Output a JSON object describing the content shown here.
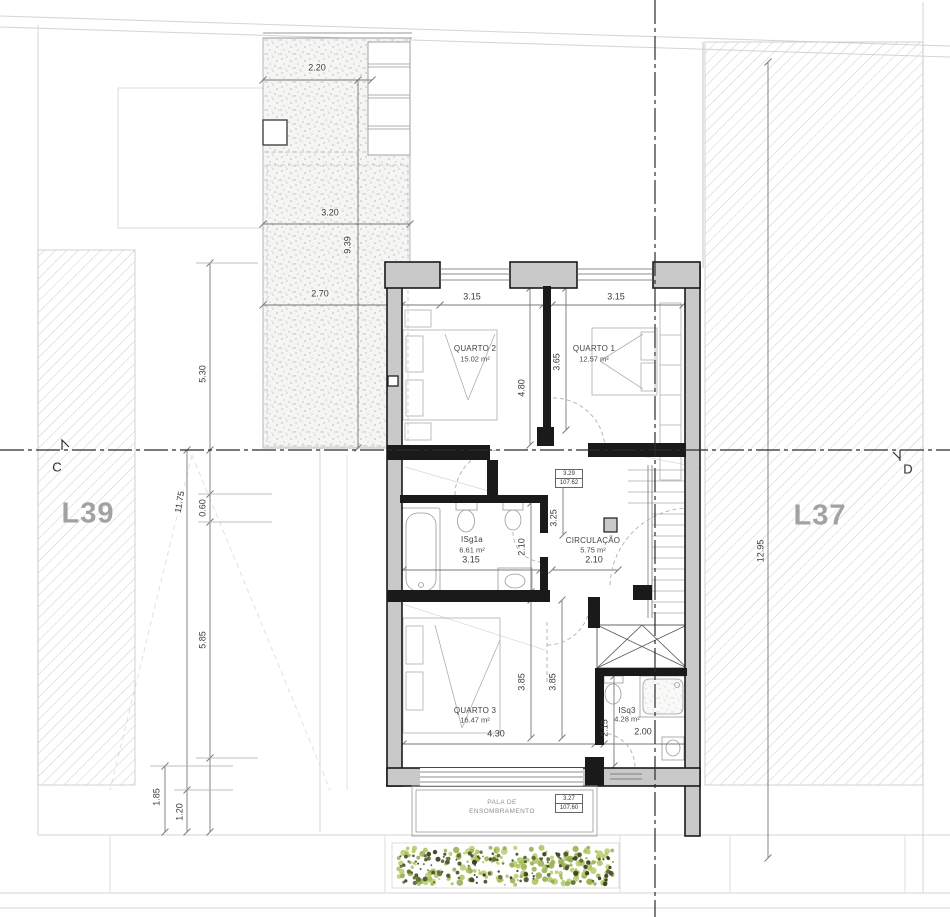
{
  "lots": {
    "left": "L39",
    "right": "L37"
  },
  "section": {
    "left": "C",
    "right": "D"
  },
  "rooms": {
    "quarto2": {
      "name": "QUARTO 2",
      "area": "15.02 m²"
    },
    "quarto1": {
      "name": "QUARTO 1",
      "area": "12.57 m²"
    },
    "isg1a": {
      "name": "ISg1a",
      "area": "6.61 m²"
    },
    "circulacao": {
      "name": "CIRCULAÇÃO",
      "area": "5.75 m²"
    },
    "quarto3": {
      "name": "QUARTO 3",
      "area": "16.47 m²"
    },
    "isq3": {
      "name": "ISq3",
      "area": "4.28 m²"
    }
  },
  "levels": {
    "upper": {
      "value": "3.29",
      "elevation": "107.62"
    },
    "lower": {
      "value": "3.27",
      "elevation": "107.60"
    }
  },
  "canopy": {
    "line1": "PALA DE",
    "line2": "ENSOMBRAMENTO"
  },
  "dims": {
    "courtyard_width_top": "2.20",
    "courtyard_width_mid": "3.20",
    "courtyard_height": "9.39",
    "courtyard_width_low": "2.70",
    "left_upper": "5.30",
    "left_total": "11.75",
    "left_offset": "0.60",
    "left_lower": "5.85",
    "front_depth": "1.85",
    "front_offset": "1.20",
    "quarto2_width": "3.15",
    "quarto1_width": "3.15",
    "quarto2_depth": "4.80",
    "quarto1_depth": "3.65",
    "hall_depth": "3.25",
    "isg1a_depth": "2.10",
    "isg1a_width": "3.15",
    "circulacao_width": "2.10",
    "quarto3_depth_a": "3.85",
    "quarto3_depth_b": "3.85",
    "quarto3_width": "4.30",
    "isq3_depth": "2.15",
    "isq3_width": "2.00",
    "right_total": "12.95"
  },
  "colors": {
    "wall_black": "#1a1a1a",
    "wall_gray": "#c9c9c9",
    "hatch": "#cdcdcd",
    "plant_light": "#b7cc6d",
    "plant_dark": "#434c26"
  }
}
